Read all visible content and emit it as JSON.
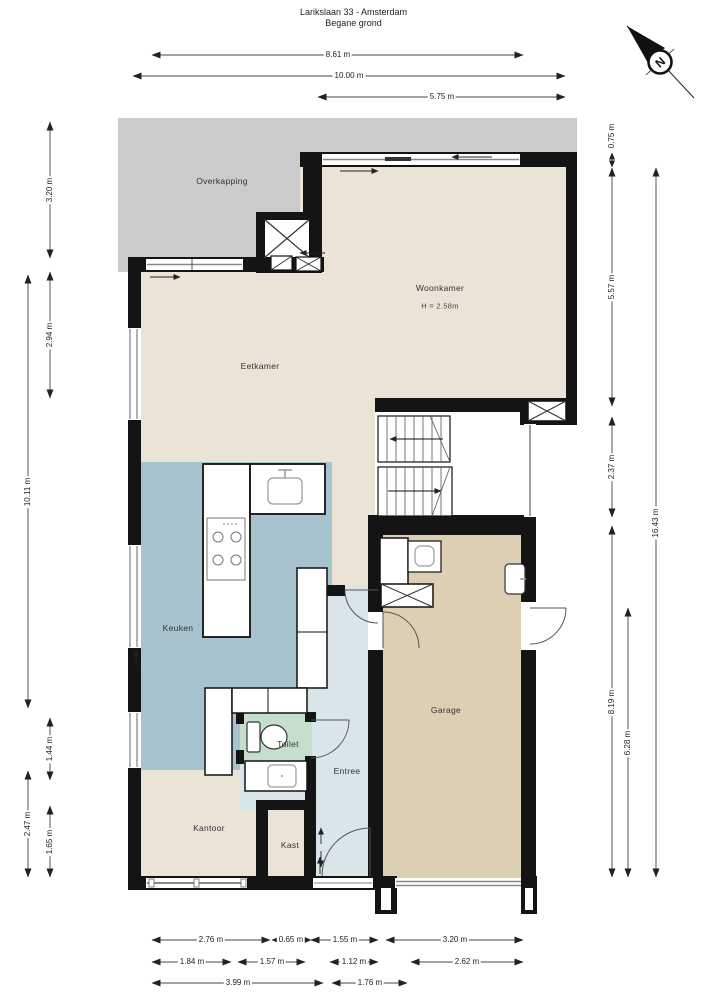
{
  "title": {
    "line1": "Larikslaan 33 - Amsterdam",
    "line2": "Begane grond"
  },
  "compass": {
    "label": "N"
  },
  "rooms": {
    "overkapping": "Overkapping",
    "woonkamer": "Woonkamer",
    "woonkamer_height": "H = 2.58m",
    "eetkamer": "Eetkamer",
    "keuken": "Keuken",
    "toilet": "Toilet",
    "entree": "Entree",
    "kantoor": "Kantoor",
    "kast": "Kast",
    "garage": "Garage"
  },
  "dims": {
    "t0": "8.61 m",
    "t1": "10.00 m",
    "t2": "5.75 m",
    "l0": "3.20 m",
    "l1": "2.94 m",
    "l2": "10.11 m",
    "l3": "1.44 m",
    "l4": "2.47 m",
    "l5": "1.65 m",
    "r0": "0.75 m",
    "r1": "5.57 m",
    "r2": "2.37 m",
    "r3": "16.43 m",
    "r4": "8.19 m",
    "r5": "6.28 m",
    "b0": "2.76 m",
    "b1": "0.65 m",
    "b2": "1.55 m",
    "b3": "3.20 m",
    "b4": "1.84 m",
    "b5": "1.57 m",
    "b6": "1.12 m",
    "b7": "2.62 m",
    "b8": "3.99 m",
    "b9": "1.76 m"
  },
  "colors": {
    "living": "#ebe3d6",
    "kitchen": "#a7c4ce",
    "entry": "#d9e5e9",
    "toilet": "#c6dfcd",
    "garage": "#ddcfb4",
    "canopy": "#cbcbcb",
    "wall": "#141414"
  }
}
